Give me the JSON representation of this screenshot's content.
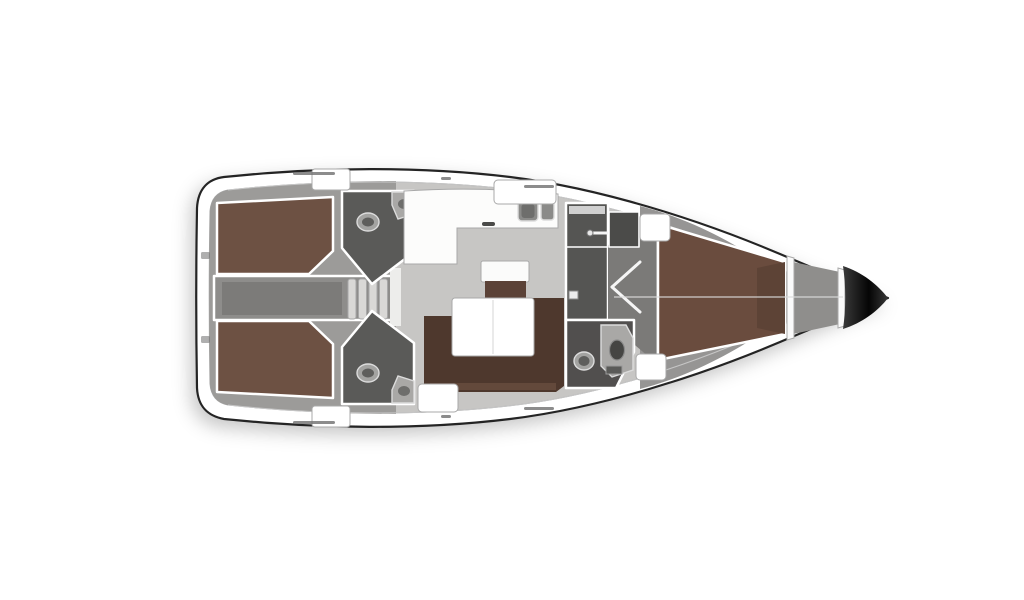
{
  "page": {
    "background": "#ffffff"
  },
  "floorplan": {
    "subject": "sailing-yacht-interior-plan-top-view",
    "colors": {
      "hull_fill": "#ffffff",
      "floor_salon": "#c7c6c4",
      "floor_aft": "#9c9b99",
      "floor_forward": "#969594",
      "engine_bar": "#8e8d8b",
      "engine_hatch": "#7c7b79",
      "step_tread": "#d9d8d6",
      "landing": "#ededeb",
      "berth_aft": "#6d5143",
      "berth_fwd": "#6a4c3e",
      "berth_fwd_end": "#5d4336",
      "sofa": "#4e382d",
      "sofa_front": "#664b3d",
      "table_white": "#ffffff",
      "sideboard_top": "#fbfbfa",
      "sideboard_base": "#5b4237",
      "galley_counter": "#fcfcfb",
      "sink_outer": "#8b8b89",
      "sink_inner": "#6e6e6c",
      "burner": "#4a4a48",
      "head_aft": "#5a5a58",
      "head_fwd": "#514f4e",
      "shower": "#555553",
      "corridor": "#7b7a78",
      "wardrobe": "#4b4b49",
      "toilet_outer": "#a3a3a1",
      "toilet_inner": "#5e5e5c",
      "sink_unit": "#a9a8a6",
      "basin_dark": "#454543",
      "locker_white": "#ffffff",
      "anchor_floor": "#8f8e8c",
      "bulkhead": "#fafafa",
      "bow_start": "#3a3a3a",
      "bow_mid": "#050505",
      "deck_detail": "#6f6f6f",
      "centerline": "#dcdcdc",
      "shelf": "#d0d0d0",
      "hatch_white": "#ffffff"
    }
  }
}
